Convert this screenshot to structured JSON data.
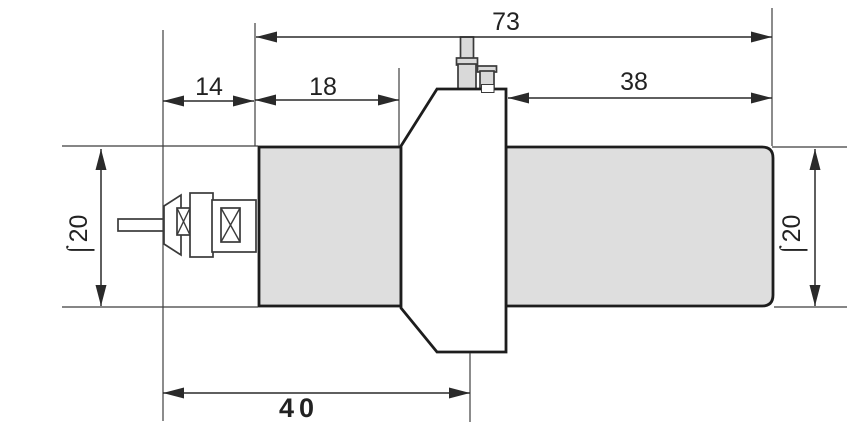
{
  "theme": {
    "background": "#ffffff",
    "cylinder_fill": "#dedede",
    "pin_fill": "#d9d9d9",
    "outline_color": "#1d1d1d",
    "dimension_color": "#2a2a2a"
  },
  "dimensions": {
    "overall_length": "73",
    "plug_section_length": "14",
    "front_body_length": "18",
    "rear_body_length": "38",
    "mounting_length": "40",
    "diameter_left": "⌠20",
    "diameter_right": "⌠20"
  }
}
